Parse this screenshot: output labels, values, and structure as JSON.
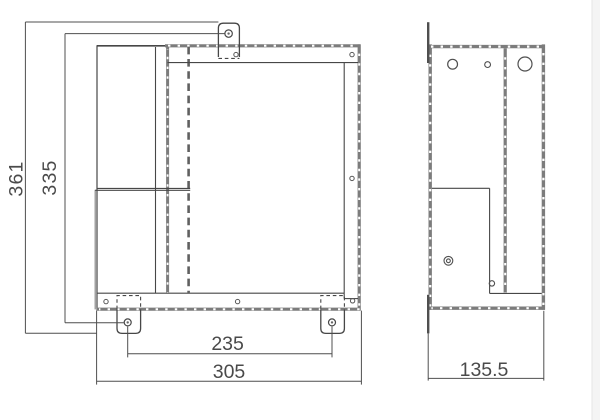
{
  "dims": {
    "overall_height": "361",
    "mount_hole_height": "335",
    "foot_hole_spacing": "235",
    "overall_width": "305",
    "depth": "135.5"
  },
  "colors": {
    "line": "#474747",
    "hatch_wall": "#7c7c7c",
    "hidden_dash": "#606060",
    "dim_text": "#4a4a4a",
    "page_edge_strip": "#f4f4f4",
    "background": "#ffffff"
  }
}
